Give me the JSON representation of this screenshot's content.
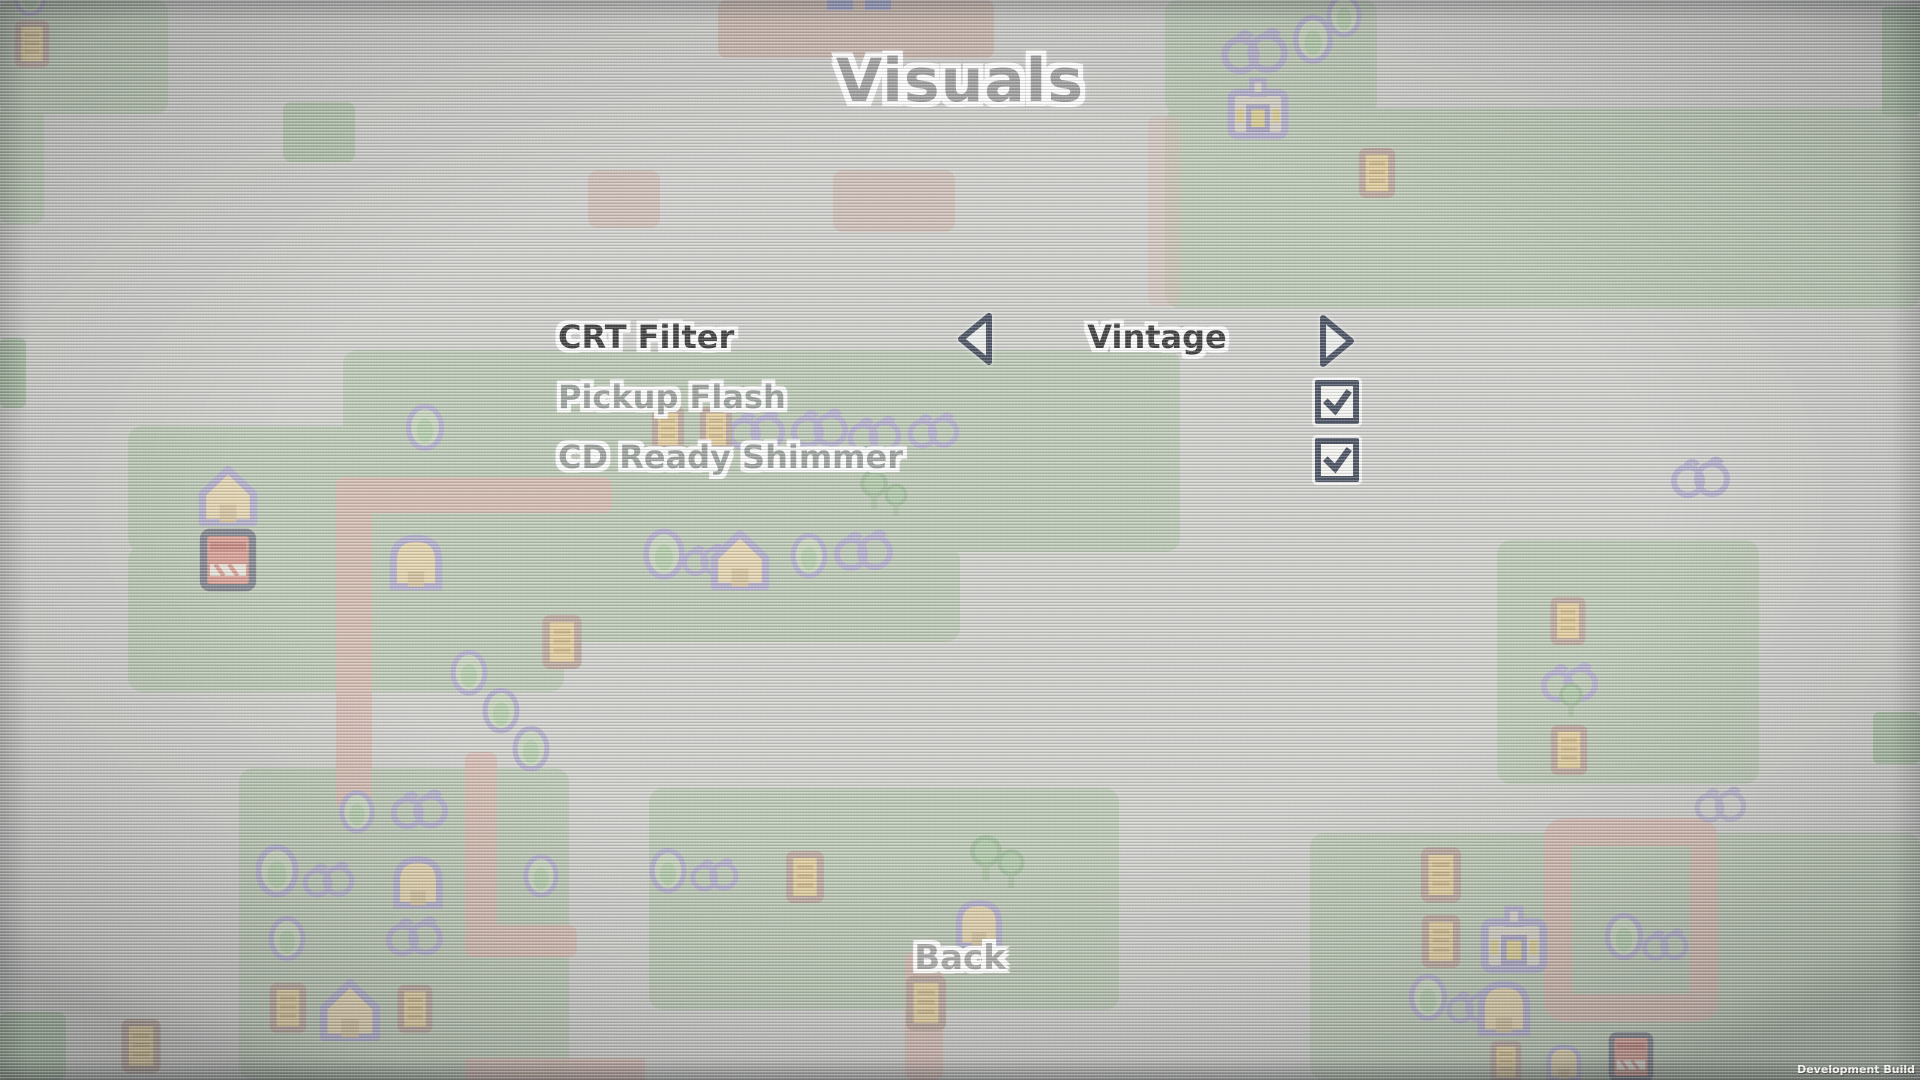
{
  "screen": {
    "title": "Visuals",
    "back_label": "Back",
    "build_label": "Development Build"
  },
  "menu": {
    "items": [
      {
        "label": "CRT Filter",
        "type": "option-selector",
        "value": "Vintage",
        "selected": true
      },
      {
        "label": "Pickup Flash",
        "type": "checkbox",
        "checked": true,
        "selected": false
      },
      {
        "label": "CD Ready Shimmer",
        "type": "checkbox",
        "checked": true,
        "selected": false
      }
    ]
  },
  "icons": {
    "left_arrow": "left-arrow",
    "right_arrow": "right-arrow",
    "checkbox_check": "checkmark"
  },
  "colors": {
    "selected_text": "#3b3b3b",
    "unselected_text": "#9da39f",
    "title_text": "#9e9e9e",
    "outline_halo": "#ffffff",
    "ui_dark_navy": "#474e60",
    "grass_green": "#a8bb9f",
    "path_pink": "#d4a398",
    "crate_yellow": "#e2c178",
    "sprite_purple": "#9a93c2"
  }
}
